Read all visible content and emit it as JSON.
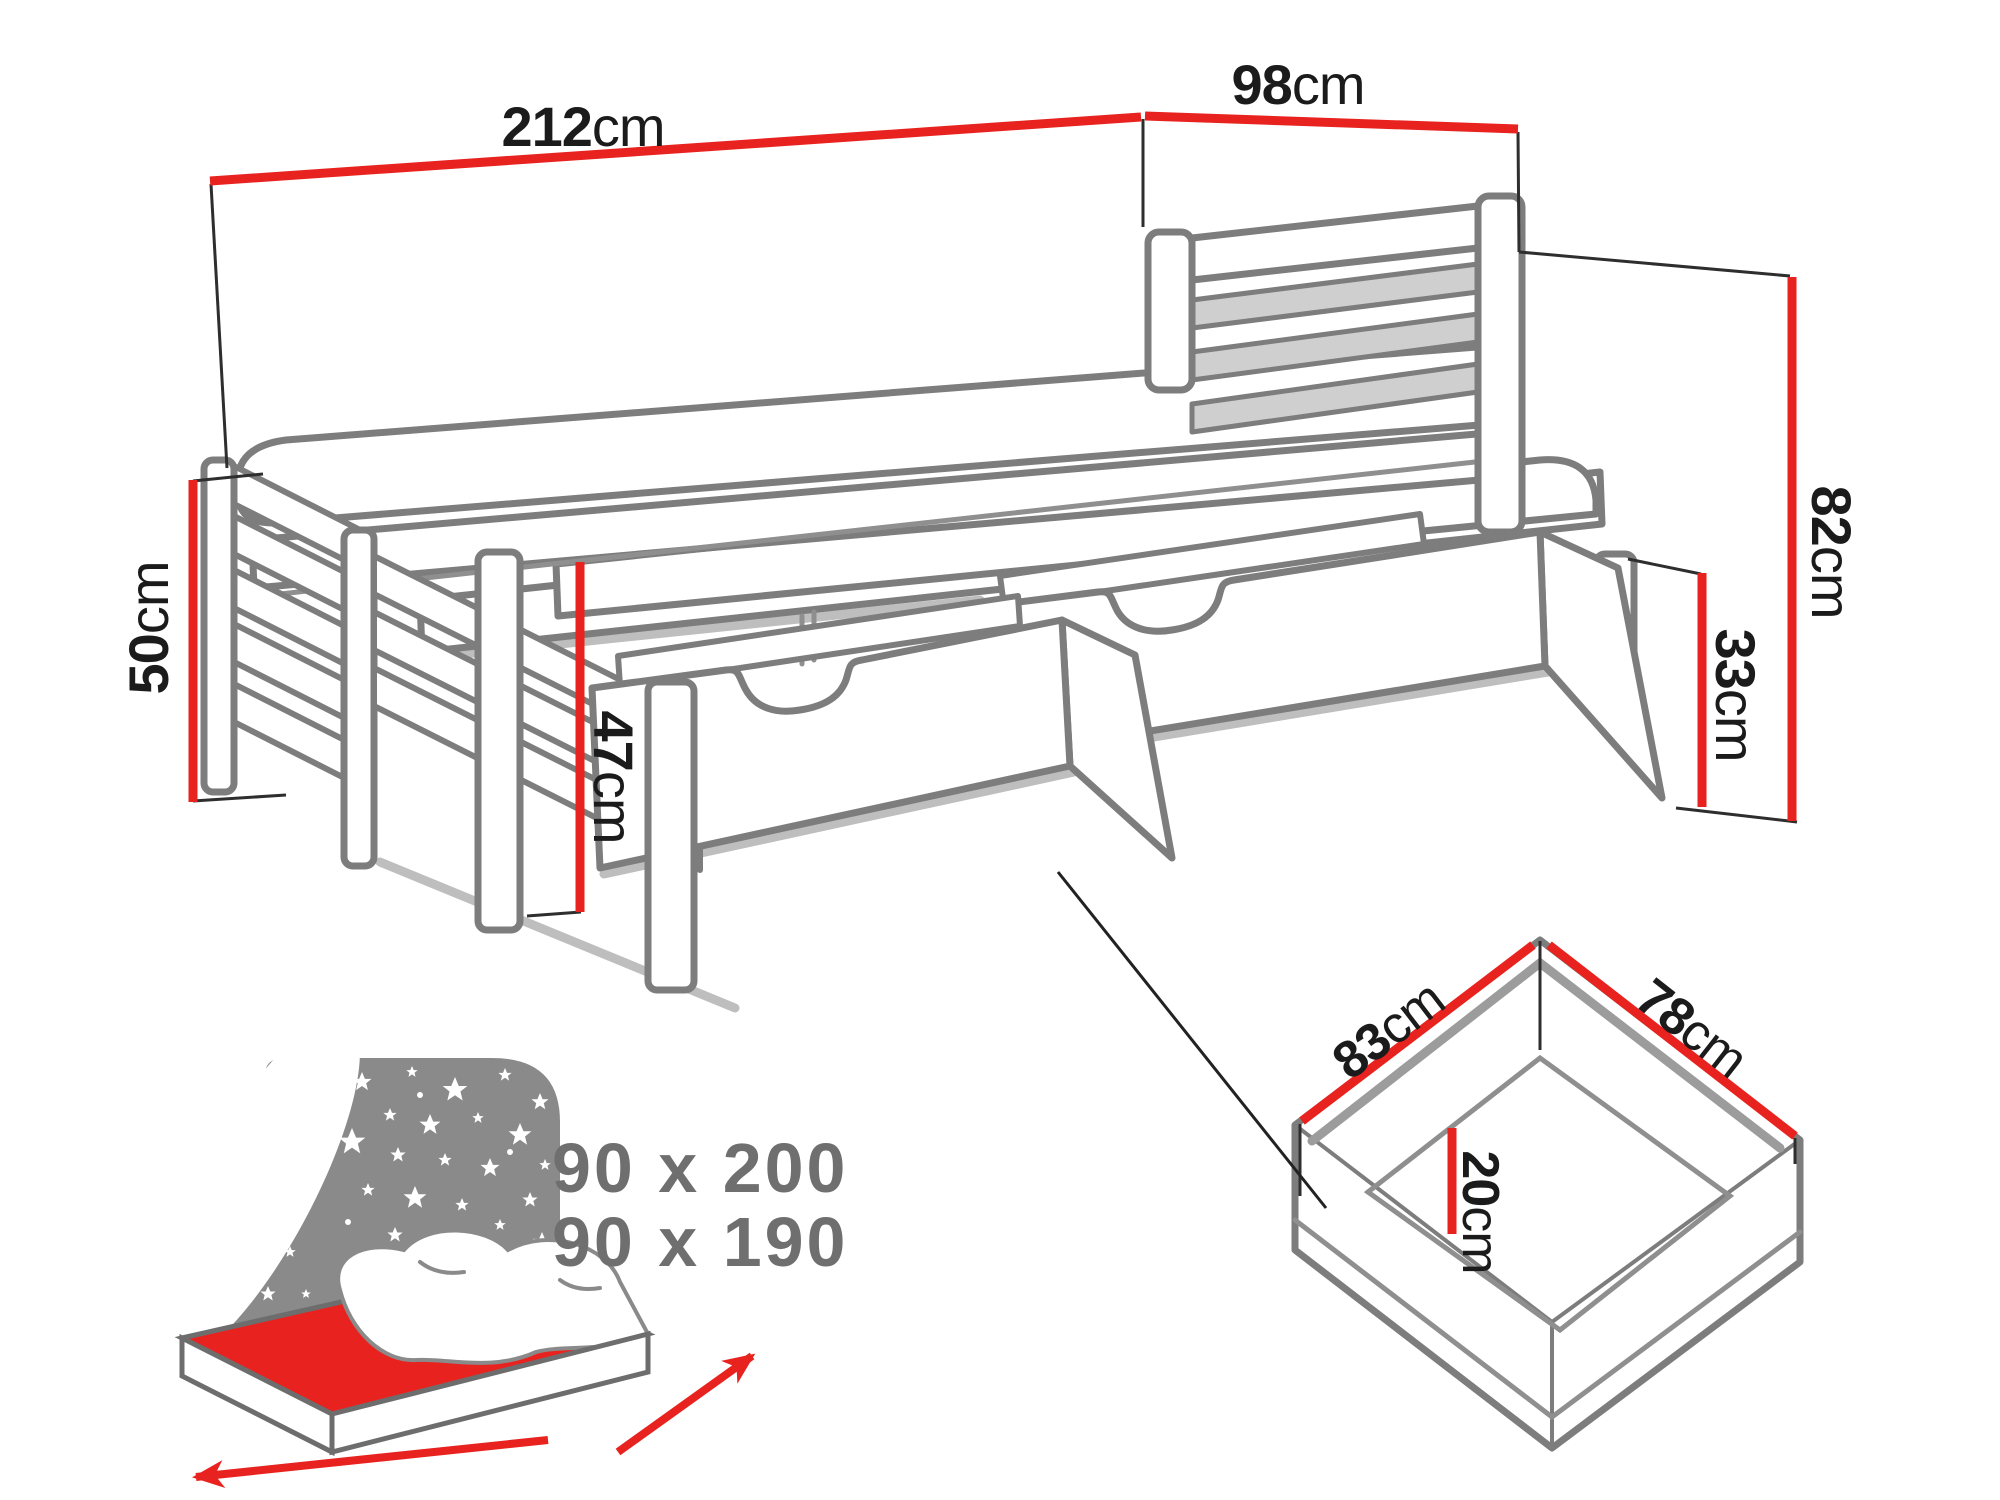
{
  "diagram": {
    "title_hint": "trundle-bed-with-drawers-dimension-diagram",
    "unit_default": "cm",
    "dimensions": {
      "total_length": {
        "value": "212",
        "unit": "cm"
      },
      "headboard_width": {
        "value": "98",
        "unit": "cm"
      },
      "headboard_height": {
        "value": "82",
        "unit": "cm"
      },
      "footboard_height": {
        "value": "50",
        "unit": "cm"
      },
      "underbed_height": {
        "value": "47",
        "unit": "cm"
      },
      "drawer_front_height": {
        "value": "33",
        "unit": "cm"
      },
      "drawer_length": {
        "value": "83",
        "unit": "cm"
      },
      "drawer_width": {
        "value": "78",
        "unit": "cm"
      },
      "drawer_inner_depth": {
        "value": "20",
        "unit": "cm"
      }
    },
    "mattress_sizes": {
      "line1": "90 x 200",
      "line2": "90 x 190"
    },
    "colors": {
      "dimension_red": "#e8231f",
      "line_gray": "#7d7d7d",
      "slat_gray": "#cfcfcf",
      "label_black": "#1b1b1b",
      "sizes_gray": "#6f6f6f",
      "icon_panel_gray": "#8a8a8a",
      "icon_mattress_red": "#e8231f",
      "background": "#ffffff"
    }
  }
}
